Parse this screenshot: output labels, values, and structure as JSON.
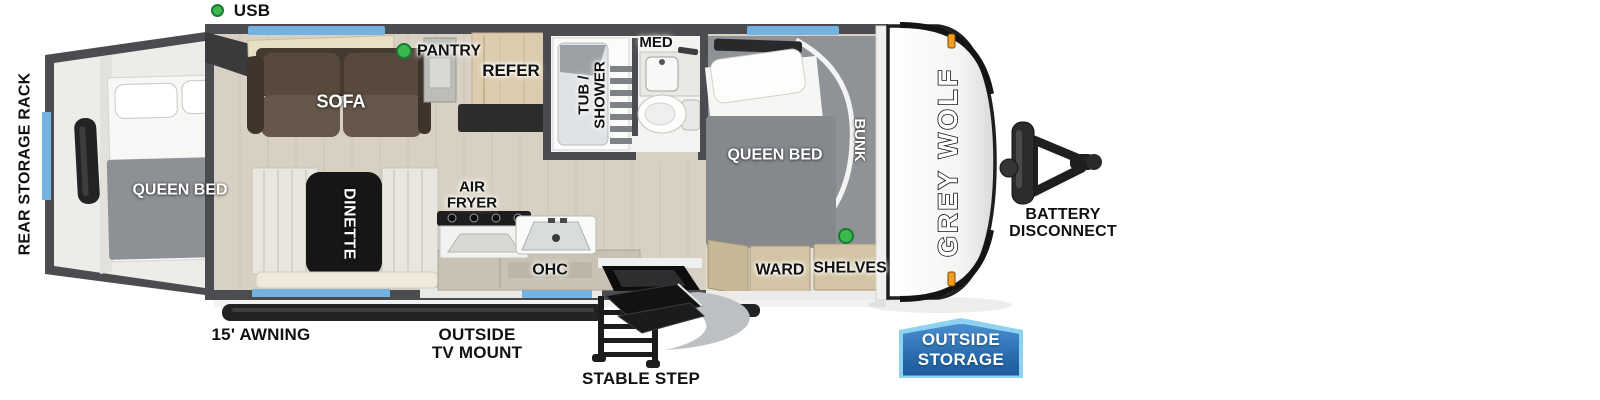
{
  "legend": {
    "usb": {
      "label": "USB"
    }
  },
  "callouts": {
    "rear_storage_rack": "REAR STORAGE RACK",
    "awning": "15' AWNING",
    "outside_tv_mount": {
      "line1": "OUTSIDE",
      "line2": "TV MOUNT"
    },
    "stable_step": "STABLE STEP",
    "battery_disconnect": {
      "line1": "BATTERY",
      "line2": "DISCONNECT"
    }
  },
  "badge": {
    "line1": "OUTSIDE",
    "line2": "STORAGE"
  },
  "brand": {
    "logo_text": "GREY WOLF"
  },
  "rooms": {
    "rear_bedroom": {
      "queen_bed": "QUEEN BED"
    },
    "living": {
      "sofa": "SOFA",
      "dinette": "DINETTE"
    },
    "kitchen": {
      "pantry": "PANTRY",
      "refer": "REFER",
      "air_fryer_line1": "AIR",
      "air_fryer_line2": "FRYER",
      "ohc": "OHC"
    },
    "bathroom": {
      "tub_shower_line1": "TUB /",
      "tub_shower_line2": "SHOWER",
      "med": "MED"
    },
    "front_bedroom": {
      "queen_bed": "QUEEN BED",
      "bunk": "BUNK",
      "ward": "WARD",
      "shelves": "SHELVES"
    }
  },
  "indicators": {
    "usb_dots": 3,
    "usb_dot_color": "#3cb94e"
  },
  "colors": {
    "wall_gray": "#4b4c4f",
    "floor_wood": "#d8d0c3",
    "rear_floor": "#edece8",
    "window_blue": "#74b3e0",
    "sofa_brown": "#574a3d",
    "cabinet_tan": "#d2c4a4",
    "bed_blanket_gray": "#85888d",
    "marker_light_orange": "#f39c1f",
    "badge_blue_dark": "#1b5a9b",
    "badge_blue_light": "#4a8fd0",
    "badge_border_blue": "#8ed2f2"
  }
}
